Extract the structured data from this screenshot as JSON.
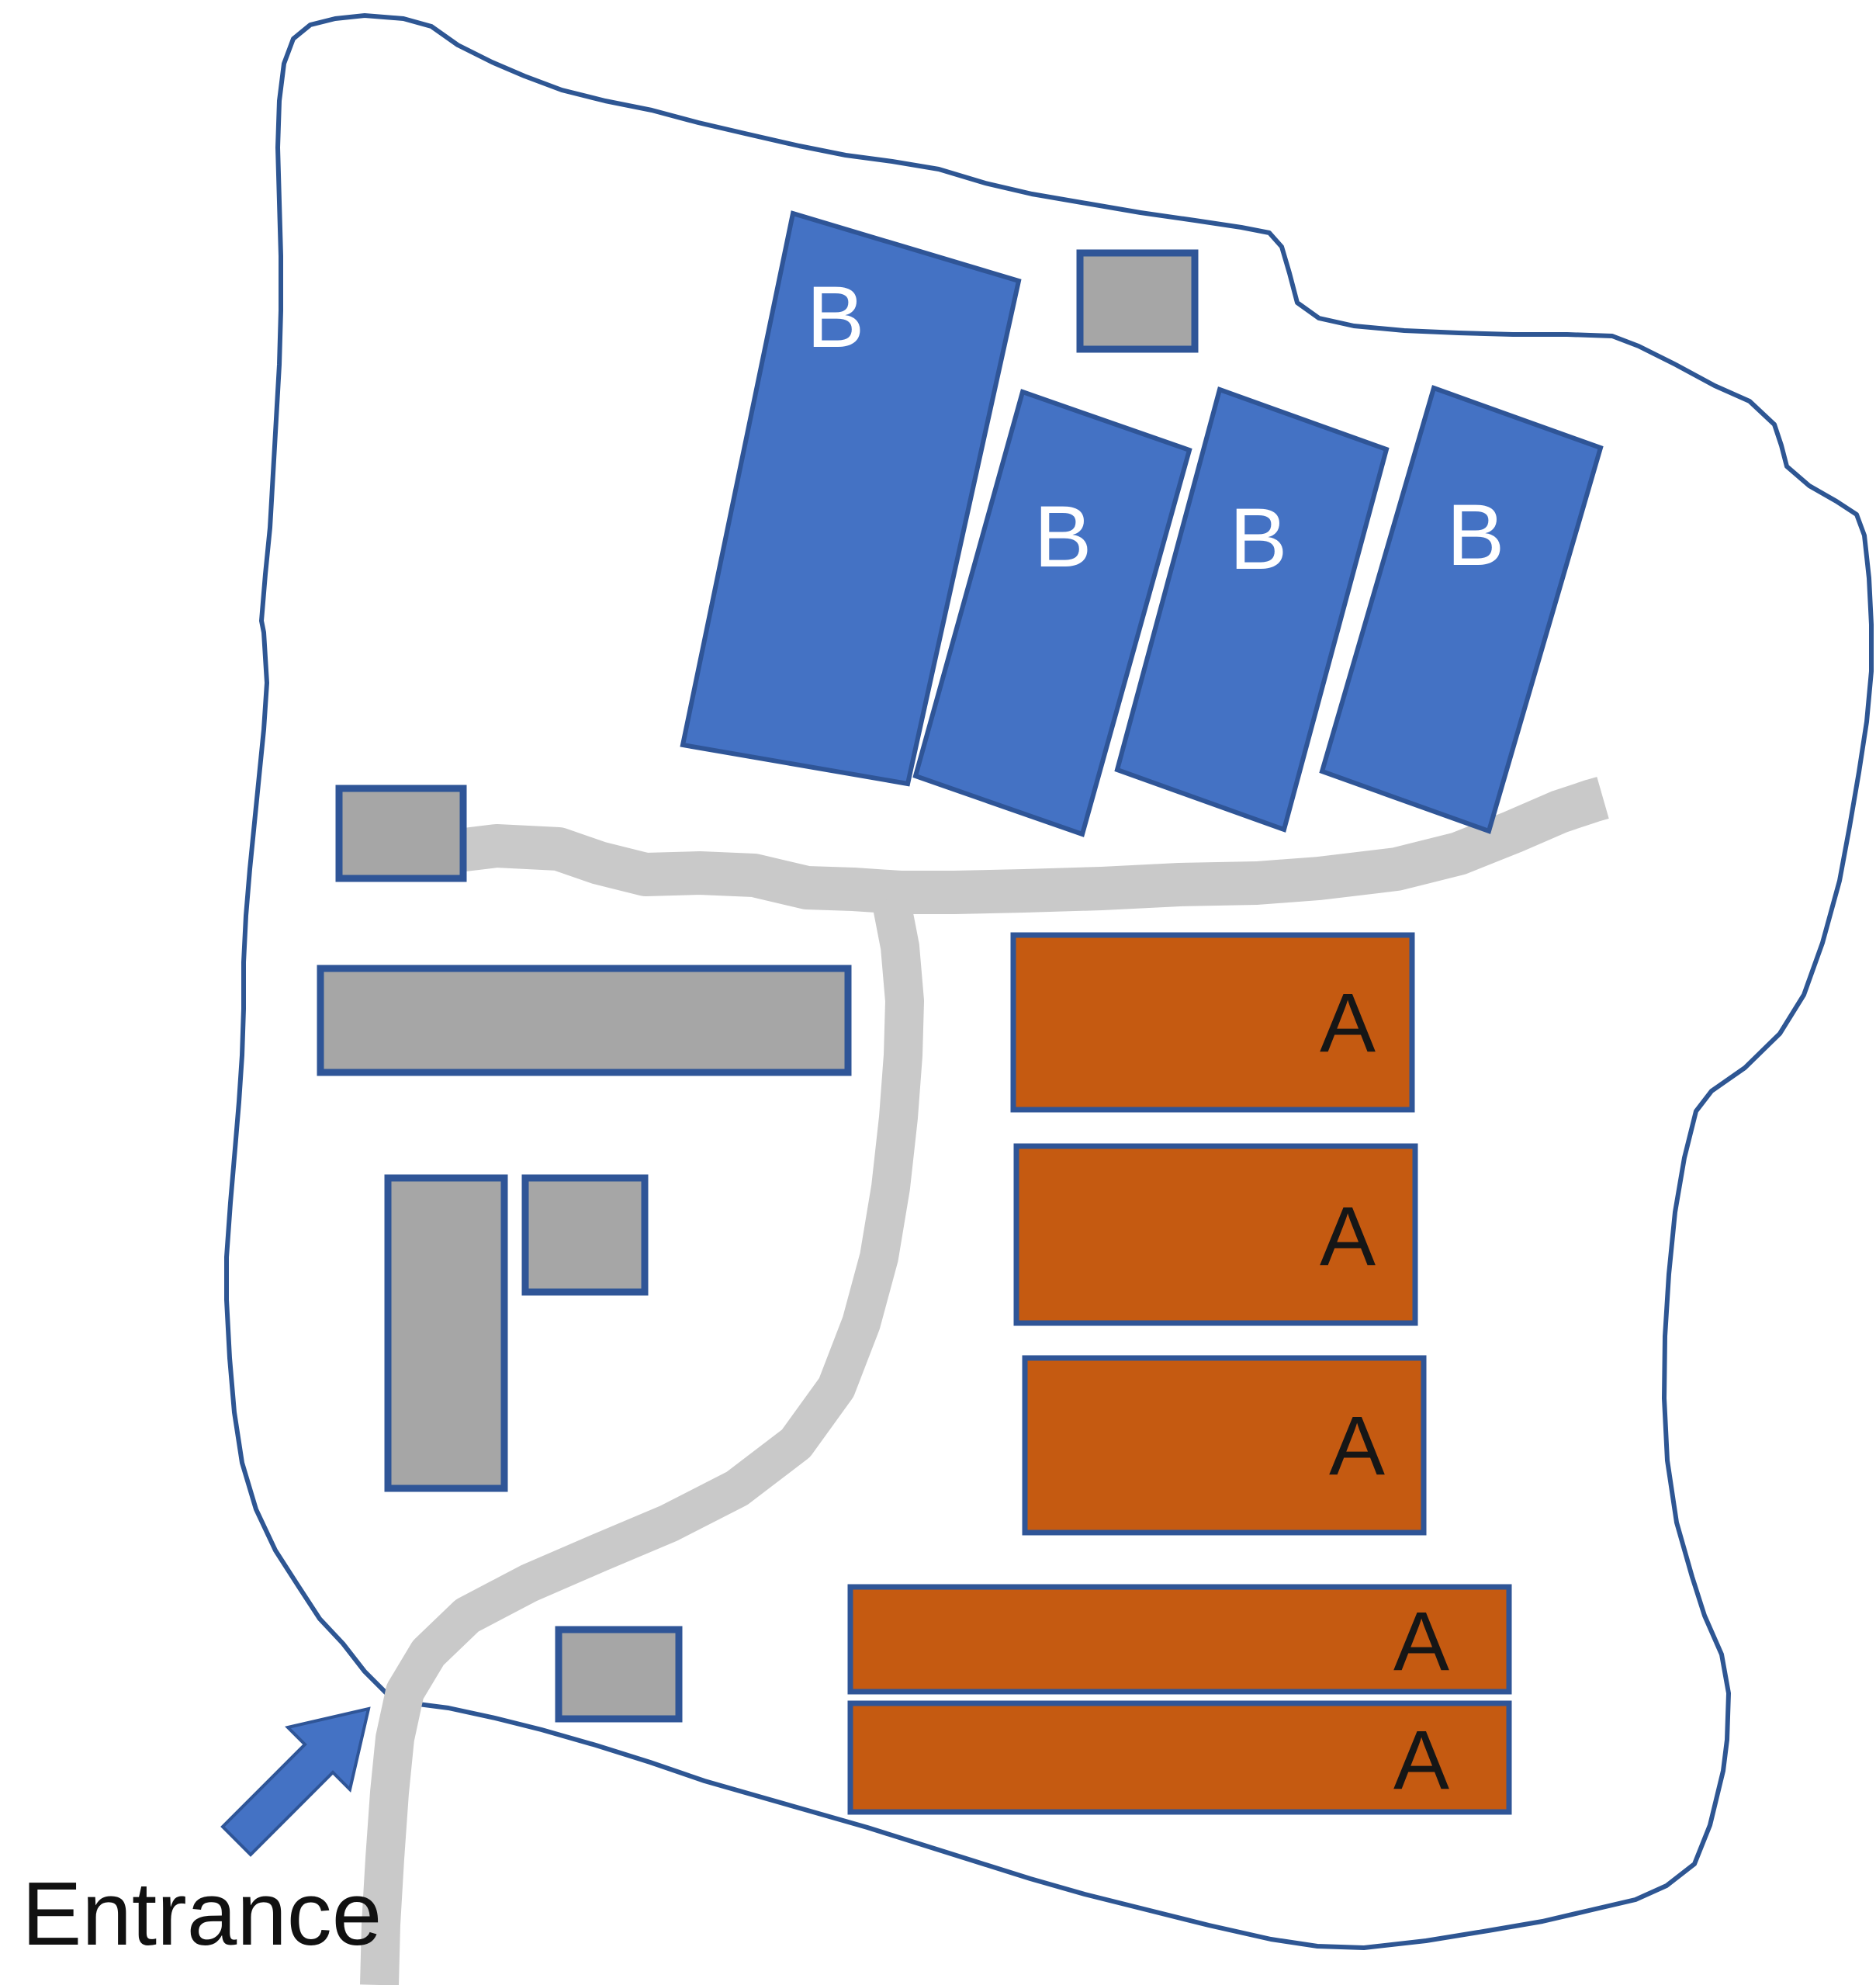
{
  "labels": {
    "entrance": "Entrance"
  },
  "buildings": {
    "b": [
      {
        "label": "B"
      },
      {
        "label": "B"
      },
      {
        "label": "B"
      },
      {
        "label": "B"
      }
    ],
    "a": [
      {
        "label": "A"
      },
      {
        "label": "A"
      },
      {
        "label": "A"
      },
      {
        "label": "A"
      },
      {
        "label": "A"
      }
    ],
    "gray_unlabeled_count": 6
  },
  "colors": {
    "building-b-fill": "#4472C4",
    "building-a-fill": "#C55A11",
    "gray-fill": "#A6A6A6",
    "shape-stroke": "#2F5597",
    "boundary-stroke": "#2E5693",
    "road-fill": "#C9C9C9",
    "label-b-color": "#FFFFFF",
    "label-a-color": "#161616",
    "entrance-color": "#111111",
    "arrow-fill": "#4472C4",
    "background": "#FFFFFF"
  }
}
